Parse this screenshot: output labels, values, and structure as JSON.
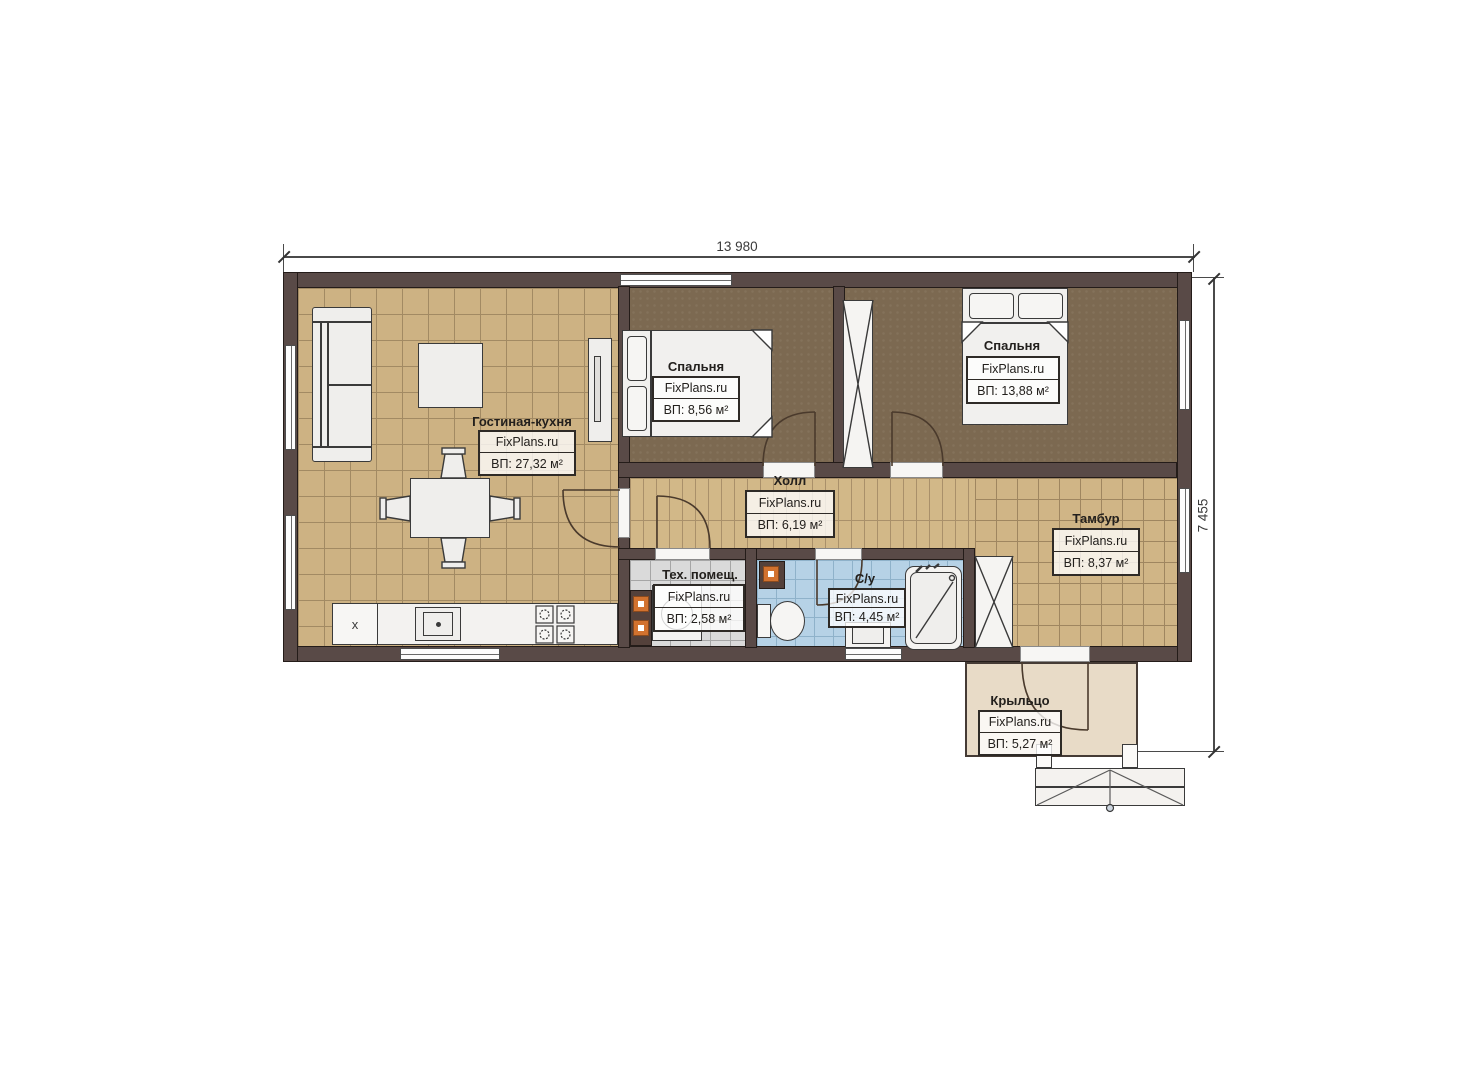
{
  "plan": {
    "dim_width": "13 980",
    "dim_height": "7 455",
    "watermark": "FixPlans.ru",
    "fridge_label": "x",
    "rooms": [
      {
        "key": "living",
        "name": "Гостиная-кухня",
        "brand": "FixPlans.ru",
        "area": "ВП: 27,32 м²"
      },
      {
        "key": "bedroom-1",
        "name": "Спальня",
        "brand": "FixPlans.ru",
        "area": "ВП: 8,56 м²"
      },
      {
        "key": "bedroom-2",
        "name": "Спальня",
        "brand": "FixPlans.ru",
        "area": "ВП: 13,88 м²"
      },
      {
        "key": "hall",
        "name": "Холл",
        "brand": "FixPlans.ru",
        "area": "ВП: 6,19 м²"
      },
      {
        "key": "tambour",
        "name": "Тамбур",
        "brand": "FixPlans.ru",
        "area": "ВП: 8,37 м²"
      },
      {
        "key": "tech",
        "name": "Тех. помещ.",
        "brand": "FixPlans.ru",
        "area": "ВП: 2,58 м²"
      },
      {
        "key": "wc",
        "name": "С/у",
        "brand": "FixPlans.ru",
        "area": "ВП: 4,45 м²"
      },
      {
        "key": "porch",
        "name": "Крыльцо",
        "brand": "FixPlans.ru",
        "area": "ВП: 5,27 м²"
      }
    ],
    "colors": {
      "wall": "#594a47",
      "floor_living": "#cdb283",
      "floor_bedroom": "#7c6951",
      "floor_tech": "#dadada",
      "floor_bath": "#b6d2e6",
      "floor_porch": "#e8dbc7",
      "heater": "#d2722f"
    }
  }
}
